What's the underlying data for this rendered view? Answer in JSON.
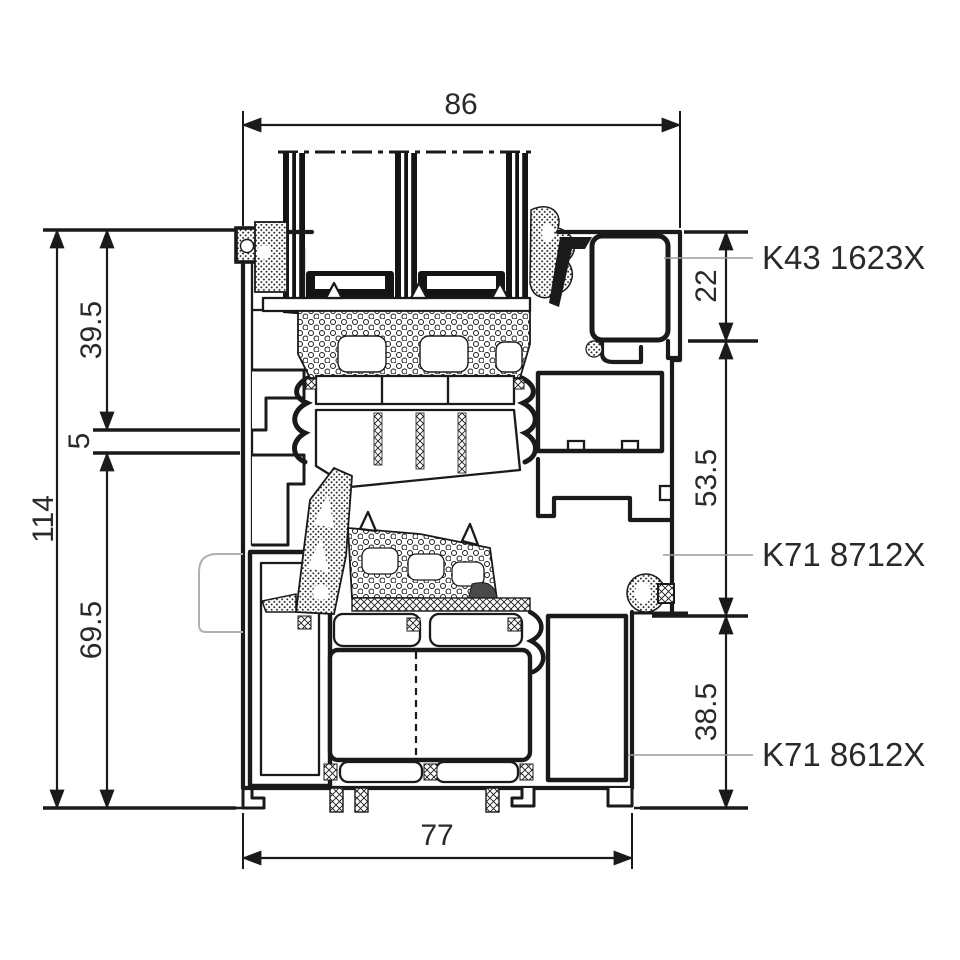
{
  "drawing": {
    "dimensions": {
      "top_width": "86",
      "bottom_width": "77",
      "overall_height": "114",
      "upper_section": "39.5",
      "gap": "5",
      "lower_section": "69.5",
      "right_top": "22",
      "right_middle": "53.5",
      "right_bottom": "38.5"
    },
    "part_labels": {
      "glazing_bead": "K43 1623X",
      "frame": "K71 8712X",
      "threshold": "K71 8612X"
    },
    "colors": {
      "line": "#1a1a1a",
      "leader_line": "#9a9a9a",
      "text": "#2a2a2a",
      "background": "#ffffff"
    }
  }
}
